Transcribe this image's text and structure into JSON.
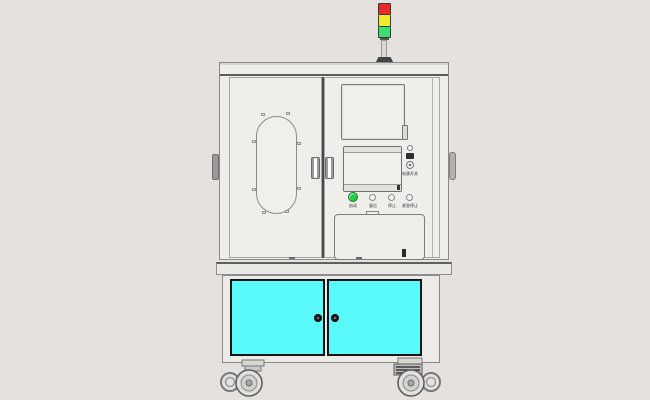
{
  "scene": {
    "background_color": "#E4E1DE",
    "subject": "industrial automation test machine cabinet, CAD-style render"
  },
  "tower": {
    "segments": [
      {
        "name": "red-lamp",
        "color": "#E82A2A"
      },
      {
        "name": "yellow-lamp",
        "color": "#F0E92C"
      },
      {
        "name": "green-lamp",
        "color": "#3ADF6F"
      }
    ],
    "pole_color": "#DBD9D6",
    "base_color": "#454545"
  },
  "upper_cabinet": {
    "body_color": "#F0EEEB",
    "frame_line_color": "#8A8A8A",
    "divider_color": "#4A4A4A"
  },
  "control_panel": {
    "start_button": {
      "label": "启动",
      "color": "#22CC44"
    },
    "buttons": [
      {
        "label": "复位"
      },
      {
        "label": "停止"
      },
      {
        "label": "紧急停止"
      }
    ],
    "side_panel_label": "电源开关",
    "port_color": "#2E2E2E"
  },
  "lower_cabinet": {
    "door_color": "#5BFAFA",
    "door_border_color": "#141414",
    "knob_color": "#1D1D1D",
    "frame_color": "#EDEBE8"
  }
}
